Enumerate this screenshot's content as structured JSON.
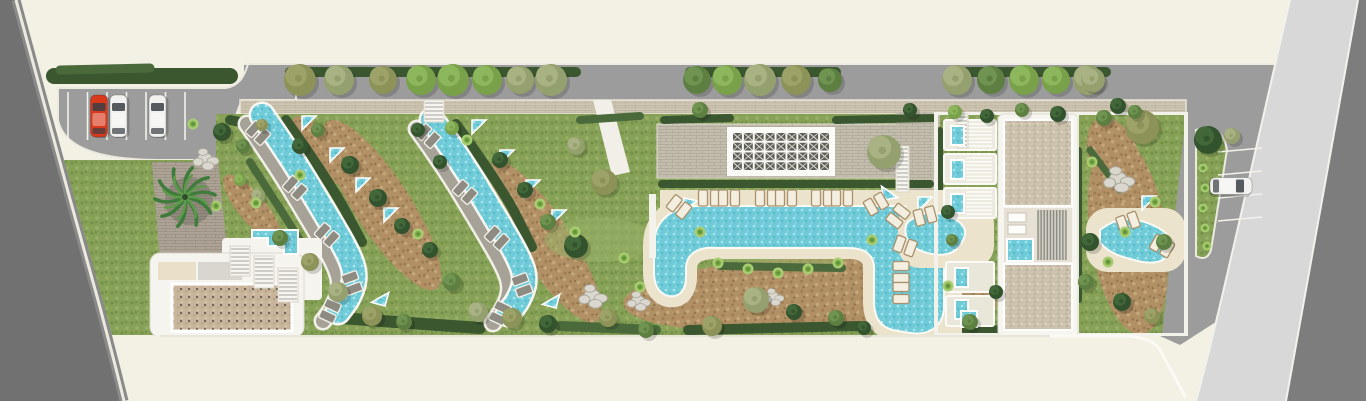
{
  "scene": {
    "kind": "resort-landscape-site-plan",
    "width": 1366,
    "height": 401
  },
  "palette": {
    "cream": "#f3f0e4",
    "road": "#9c9c9c",
    "road_dark": "#717171",
    "road_dark2": "#7d7d7d",
    "road_light": "#d8d8d8",
    "curb": "#efede3",
    "lawn": "#87a257",
    "lawn_dark": "#74914a",
    "lawn_light": "#97b068",
    "brown": "#b09064",
    "brown_dark": "#9c7c50",
    "brown_light": "#c4a87c",
    "water": "#70cbd9",
    "water_light": "#a9e6ec",
    "water_dark": "#54b9c9",
    "deck": "#ece3cd",
    "paver": "#c3bdae",
    "paver_line": "#afa999",
    "paver_tan": "#cec5b2",
    "paver_tan_line": "#bbb19c",
    "drive": "#aca295",
    "drive_line": "#9a9083",
    "gravel": "#ccc2ae",
    "gravel_tan": "#c8b49a",
    "wall": "#f5f4ef",
    "hedge": "#3b5730",
    "hedge2": "#4a6a3c",
    "lounger_gray": "#8e8c82",
    "lounger_gray_stroke": "#f4f2ea",
    "lounger_tan": "#f3eedf",
    "lounger_tan_stroke": "#a8916c",
    "path_gray": "#a6a298",
    "stair_line": "#a5a5a0",
    "pergola_cell": "#5f5f58",
    "rock": "#dad7ce",
    "rock_edge": "#a9a69c",
    "car_red": "#d93a1e",
    "car_white": "#f1f1ef",
    "glass": "#3a3f44",
    "palm_dark": "#3f7c3c",
    "palm_light": "#5d9a4a",
    "bush_dot": "#a9cd72",
    "bush_dot_mid": "#7fae4a",
    "bush_dot_core": "#5d8f3a",
    "tree_tones": {
      "dark": [
        "#33532e",
        "#42683a"
      ],
      "mid": [
        "#5d7f41",
        "#6f9350"
      ],
      "bright": [
        "#79a149",
        "#8db75c"
      ],
      "sage": [
        "#95a06f",
        "#a8b282"
      ],
      "olive": [
        "#8c9258",
        "#9da368"
      ]
    }
  },
  "road_trees": {
    "y": 80,
    "items": [
      [
        300,
        16,
        "olive"
      ],
      [
        339,
        15,
        "sage"
      ],
      [
        383,
        14,
        "olive"
      ],
      [
        421,
        15,
        "bright"
      ],
      [
        453,
        16,
        "bright"
      ],
      [
        487,
        15,
        "bright"
      ],
      [
        520,
        14,
        "sage"
      ],
      [
        551,
        16,
        "sage"
      ],
      [
        697,
        14,
        "mid"
      ],
      [
        727,
        15,
        "bright"
      ],
      [
        760,
        16,
        "sage"
      ],
      [
        796,
        15,
        "olive"
      ],
      [
        830,
        12,
        "mid"
      ],
      [
        957,
        15,
        "sage"
      ],
      [
        991,
        14,
        "mid"
      ],
      [
        1024,
        15,
        "bright"
      ],
      [
        1056,
        14,
        "bright"
      ],
      [
        1088,
        15,
        "sage"
      ],
      [
        1093,
        12,
        "sage"
      ]
    ]
  },
  "garden_trees": [
    [
      222,
      132,
      9,
      "dark"
    ],
    [
      243,
      146,
      7,
      "mid"
    ],
    [
      262,
      125,
      6,
      "olive"
    ],
    [
      300,
      146,
      8,
      "dark"
    ],
    [
      318,
      130,
      7,
      "mid"
    ],
    [
      350,
      165,
      9,
      "dark"
    ],
    [
      378,
      198,
      9,
      "dark"
    ],
    [
      402,
      226,
      8,
      "dark"
    ],
    [
      258,
      196,
      7,
      "sage"
    ],
    [
      240,
      180,
      6,
      "bright"
    ],
    [
      280,
      238,
      8,
      "mid"
    ],
    [
      310,
      262,
      9,
      "olive"
    ],
    [
      338,
      292,
      10,
      "sage"
    ],
    [
      372,
      316,
      10,
      "olive"
    ],
    [
      404,
      322,
      8,
      "mid"
    ],
    [
      430,
      250,
      8,
      "dark"
    ],
    [
      452,
      282,
      9,
      "mid"
    ],
    [
      478,
      312,
      10,
      "sage"
    ],
    [
      452,
      128,
      7,
      "bright"
    ],
    [
      500,
      160,
      8,
      "dark"
    ],
    [
      525,
      190,
      8,
      "dark"
    ],
    [
      548,
      222,
      8,
      "mid"
    ],
    [
      512,
      318,
      10,
      "olive"
    ],
    [
      548,
      324,
      9,
      "dark"
    ],
    [
      576,
      146,
      9,
      "sage"
    ],
    [
      604,
      182,
      13,
      "olive"
    ],
    [
      576,
      246,
      12,
      "dark"
    ],
    [
      608,
      318,
      9,
      "olive"
    ],
    [
      646,
      330,
      8,
      "mid"
    ],
    [
      700,
      110,
      8,
      "mid"
    ],
    [
      884,
      152,
      17,
      "sage"
    ],
    [
      756,
      300,
      13,
      "sage"
    ],
    [
      794,
      312,
      8,
      "dark"
    ],
    [
      712,
      326,
      10,
      "olive"
    ],
    [
      836,
      318,
      8,
      "mid"
    ],
    [
      864,
      328,
      7,
      "dark"
    ],
    [
      910,
      110,
      7,
      "dark"
    ],
    [
      955,
      112,
      7,
      "bright"
    ],
    [
      987,
      116,
      7,
      "dark"
    ],
    [
      1022,
      110,
      7,
      "mid"
    ],
    [
      1058,
      114,
      8,
      "dark"
    ],
    [
      1104,
      118,
      8,
      "mid"
    ],
    [
      1142,
      127,
      17,
      "olive"
    ],
    [
      948,
      212,
      7,
      "dark"
    ],
    [
      952,
      240,
      6,
      "mid"
    ],
    [
      996,
      292,
      7,
      "dark"
    ],
    [
      970,
      322,
      8,
      "mid"
    ],
    [
      1090,
      242,
      9,
      "dark"
    ],
    [
      1086,
      282,
      8,
      "mid"
    ],
    [
      1122,
      302,
      9,
      "dark"
    ],
    [
      1152,
      316,
      8,
      "olive"
    ],
    [
      1164,
      242,
      8,
      "mid"
    ],
    [
      1118,
      106,
      8,
      "dark"
    ],
    [
      1135,
      112,
      7,
      "mid"
    ],
    [
      1208,
      140,
      14,
      "dark"
    ],
    [
      1232,
      136,
      8,
      "sage"
    ],
    [
      418,
      130,
      7,
      "dark"
    ],
    [
      440,
      162,
      7,
      "dark"
    ]
  ],
  "dot_bushes": [
    [
      193,
      124
    ],
    [
      216,
      206
    ],
    [
      256,
      203
    ],
    [
      300,
      175
    ],
    [
      418,
      234
    ],
    [
      467,
      140
    ],
    [
      540,
      204
    ],
    [
      575,
      232
    ],
    [
      640,
      287
    ],
    [
      700,
      232
    ],
    [
      718,
      263
    ],
    [
      748,
      269
    ],
    [
      778,
      273
    ],
    [
      808,
      269
    ],
    [
      838,
      263
    ],
    [
      948,
      286
    ],
    [
      1092,
      162
    ],
    [
      1125,
      232
    ],
    [
      1155,
      202
    ],
    [
      1108,
      262
    ],
    [
      872,
      240
    ],
    [
      624,
      258
    ]
  ],
  "island_dots": [
    [
      1203,
      168
    ],
    [
      1205,
      188
    ],
    [
      1203,
      208
    ],
    [
      1205,
      228
    ],
    [
      1207,
      246
    ]
  ],
  "rocks": [
    [
      205,
      158,
      1.0
    ],
    [
      592,
      295,
      1.1
    ],
    [
      638,
      300,
      0.9
    ],
    [
      1118,
      178,
      1.2
    ],
    [
      773,
      296,
      0.8
    ]
  ],
  "palm": {
    "x": 185,
    "y": 197,
    "r": 30
  },
  "cars": [
    {
      "x": 99,
      "y": 116,
      "angle": 0,
      "color": "red",
      "name": "red-car"
    },
    {
      "x": 118.5,
      "y": 116,
      "angle": 0,
      "color": "white",
      "name": "white-car"
    },
    {
      "x": 157.5,
      "y": 116,
      "angle": 0,
      "color": "white",
      "name": "white-car"
    },
    {
      "x": 1231,
      "y": 186,
      "angle": 90,
      "color": "white",
      "name": "white-car"
    }
  ],
  "parking_left": {
    "x0": 68,
    "gap": 19.5,
    "lines": 7,
    "y0": 92,
    "len": 48
  },
  "parking_right": {
    "lines": [
      [
        1218,
        152,
        1262,
        148
      ],
      [
        1218,
        175,
        1262,
        171
      ],
      [
        1218,
        198,
        1262,
        194
      ],
      [
        1218,
        221,
        1262,
        217
      ]
    ]
  },
  "rivers": [
    {
      "pts": [
        [
          262,
          115
        ],
        [
          288,
          152
        ],
        [
          322,
          208
        ],
        [
          348,
          252
        ],
        [
          356,
          275
        ],
        [
          350,
          296
        ],
        [
          338,
          312
        ]
      ],
      "loungers": [
        [
          258,
          133,
          42
        ],
        [
          295,
          188,
          42
        ],
        [
          327,
          235,
          42
        ],
        [
          352,
          283,
          70
        ],
        [
          330,
          311,
          115
        ]
      ],
      "triangles": [
        [
          302,
          116,
          0
        ],
        [
          330,
          148,
          0
        ],
        [
          356,
          178,
          0
        ],
        [
          384,
          208,
          0
        ],
        [
          385,
          306,
          195
        ]
      ]
    },
    {
      "pts": [
        [
          432,
          120
        ],
        [
          458,
          156
        ],
        [
          492,
          212
        ],
        [
          518,
          256
        ],
        [
          526,
          278
        ],
        [
          520,
          298
        ],
        [
          508,
          314
        ]
      ],
      "loungers": [
        [
          428,
          136,
          42
        ],
        [
          465,
          192,
          42
        ],
        [
          497,
          238,
          42
        ],
        [
          522,
          285,
          70
        ],
        [
          500,
          313,
          115
        ]
      ],
      "triangles": [
        [
          472,
          120,
          0
        ],
        [
          500,
          150,
          0
        ],
        [
          526,
          180,
          0
        ],
        [
          552,
          210,
          0
        ],
        [
          556,
          308,
          195
        ]
      ]
    }
  ],
  "upool": {
    "loungers": [
      [
        679,
        207,
        38
      ],
      [
        709,
        198,
        0
      ],
      [
        729,
        198,
        0
      ],
      [
        766,
        198,
        0
      ],
      [
        786,
        198,
        0
      ],
      [
        822,
        198,
        0
      ],
      [
        842,
        198,
        0
      ],
      [
        876,
        204,
        -30
      ],
      [
        898,
        216,
        -52
      ],
      [
        901,
        272,
        90
      ],
      [
        901,
        293,
        90
      ]
    ],
    "triangles": [
      [
        684,
        198,
        12
      ],
      [
        884,
        200,
        -100
      ]
    ]
  },
  "side_pools": {
    "loungers": [
      [
        925,
        216,
        -15
      ],
      [
        905,
        246,
        20
      ],
      [
        1128,
        222,
        -20
      ],
      [
        1162,
        246,
        30
      ]
    ],
    "triangles": [
      [
        918,
        197,
        0
      ],
      [
        1142,
        196,
        0
      ]
    ]
  },
  "plunge_pools": [
    [
      951,
      126
    ],
    [
      951,
      160
    ],
    [
      951,
      194
    ],
    [
      955,
      268
    ],
    [
      955,
      300
    ]
  ],
  "jacuzzis": [
    [
      1008,
      240,
      24,
      20
    ],
    [
      962,
      312,
      14,
      14
    ]
  ],
  "pergola": {
    "x": 729,
    "y": 129,
    "w": 104,
    "h": 45,
    "cols": 9,
    "rows": 4
  },
  "stairs": [
    [
      424,
      100,
      20,
      22
    ],
    [
      896,
      146,
      13,
      46
    ],
    [
      957,
      114,
      11,
      34
    ],
    [
      230,
      246,
      20,
      30
    ],
    [
      254,
      256,
      20,
      32
    ],
    [
      278,
      268,
      20,
      34
    ]
  ],
  "louvers": [
    {
      "x": 1038,
      "y": 210,
      "w": 28,
      "h": 50,
      "n": 9,
      "dir": "v"
    },
    {
      "x": 966,
      "y": 124,
      "w": 26,
      "h": 22,
      "n": 6,
      "dir": "h"
    },
    {
      "x": 966,
      "y": 158,
      "w": 26,
      "h": 22,
      "n": 6,
      "dir": "h"
    },
    {
      "x": 966,
      "y": 192,
      "w": 26,
      "h": 22,
      "n": 6,
      "dir": "h"
    }
  ],
  "hedges": [
    {
      "w": 16,
      "t": "hedge",
      "pts": [
        [
          54,
          76
        ],
        [
          230,
          76
        ]
      ]
    },
    {
      "w": 9,
      "t": "hedge2",
      "pts": [
        [
          60,
          70
        ],
        [
          150,
          68
        ]
      ]
    },
    {
      "w": 10,
      "t": "hedge",
      "pts": [
        [
          290,
          72
        ],
        [
          576,
          72
        ]
      ]
    },
    {
      "w": 10,
      "t": "hedge",
      "pts": [
        [
          690,
          72
        ],
        [
          836,
          72
        ]
      ]
    },
    {
      "w": 10,
      "t": "hedge",
      "pts": [
        [
          950,
          72
        ],
        [
          1106,
          72
        ]
      ]
    },
    {
      "w": 10,
      "t": "hedge",
      "pts": [
        [
          230,
          120
        ],
        [
          282,
          130
        ]
      ]
    },
    {
      "w": 10,
      "t": "hedge",
      "pts": [
        [
          286,
          120
        ],
        [
          330,
          182
        ],
        [
          362,
          242
        ]
      ]
    },
    {
      "w": 10,
      "t": "hedge",
      "pts": [
        [
          456,
          124
        ],
        [
          502,
          187
        ],
        [
          532,
          247
        ]
      ]
    },
    {
      "w": 8,
      "t": "hedge2",
      "pts": [
        [
          250,
          162
        ],
        [
          300,
          240
        ]
      ]
    },
    {
      "w": 8,
      "t": "hedge",
      "pts": [
        [
          662,
          184
        ],
        [
          930,
          184
        ]
      ]
    },
    {
      "w": 8,
      "t": "hedge",
      "pts": [
        [
          664,
          120
        ],
        [
          730,
          118
        ]
      ]
    },
    {
      "w": 8,
      "t": "hedge",
      "pts": [
        [
          836,
          120
        ],
        [
          934,
          118
        ]
      ]
    },
    {
      "w": 8,
      "t": "hedge2",
      "pts": [
        [
          580,
          120
        ],
        [
          640,
          116
        ]
      ]
    },
    {
      "w": 12,
      "t": "hedge",
      "pts": [
        [
          340,
          318
        ],
        [
          480,
          328
        ]
      ]
    },
    {
      "w": 10,
      "t": "hedge2",
      "pts": [
        [
          560,
          326
        ],
        [
          656,
          330
        ]
      ]
    },
    {
      "w": 10,
      "t": "hedge",
      "pts": [
        [
          688,
          330
        ],
        [
          860,
          326
        ]
      ]
    },
    {
      "w": 9,
      "t": "hedge",
      "pts": [
        [
          906,
          326
        ],
        [
          1000,
          330
        ]
      ]
    },
    {
      "w": 8,
      "t": "hedge2",
      "pts": [
        [
          720,
          266
        ],
        [
          842,
          268
        ]
      ]
    },
    {
      "w": 6,
      "t": "hedge",
      "pts": [
        [
          940,
          130
        ],
        [
          940,
          320
        ]
      ]
    },
    {
      "w": 6,
      "t": "hedge",
      "pts": [
        [
          1079,
          150
        ],
        [
          1079,
          300
        ]
      ]
    },
    {
      "w": 8,
      "t": "hedge",
      "pts": [
        [
          1006,
          118
        ],
        [
          1070,
          118
        ]
      ]
    },
    {
      "w": 7,
      "t": "hedge2",
      "pts": [
        [
          1090,
          150
        ],
        [
          1120,
          190
        ]
      ]
    }
  ],
  "ground_patches": [
    {
      "cx": 382,
      "cy": 205,
      "rx": 100,
      "ry": 28,
      "rot": 57,
      "type": "brown"
    },
    {
      "cx": 545,
      "cy": 242,
      "rx": 95,
      "ry": 26,
      "rot": 57,
      "type": "brown"
    },
    {
      "cx": 788,
      "cy": 295,
      "rx": 165,
      "ry": 36,
      "rot": -3,
      "type": "brown"
    },
    {
      "cx": 1128,
      "cy": 235,
      "rx": 100,
      "ry": 38,
      "rot": 82,
      "type": "brown"
    },
    {
      "cx": 252,
      "cy": 208,
      "rx": 42,
      "ry": 14,
      "rot": 50,
      "type": "brown"
    },
    {
      "cx": 318,
      "cy": 150,
      "rx": 40,
      "ry": 16,
      "rot": 55,
      "type": "brown"
    },
    {
      "cx": 965,
      "cy": 300,
      "rx": 32,
      "ry": 20,
      "rot": 10,
      "type": "brown"
    },
    {
      "cx": 1115,
      "cy": 160,
      "rx": 45,
      "ry": 25,
      "rot": 70,
      "type": "brown"
    },
    {
      "cx": 600,
      "cy": 240,
      "rx": 55,
      "ry": 22,
      "rot": 0,
      "type": "light"
    },
    {
      "cx": 480,
      "cy": 180,
      "rx": 45,
      "ry": 18,
      "rot": 57,
      "type": "light"
    },
    {
      "cx": 780,
      "cy": 255,
      "rx": 70,
      "ry": 14,
      "rot": 0,
      "type": "light"
    }
  ]
}
